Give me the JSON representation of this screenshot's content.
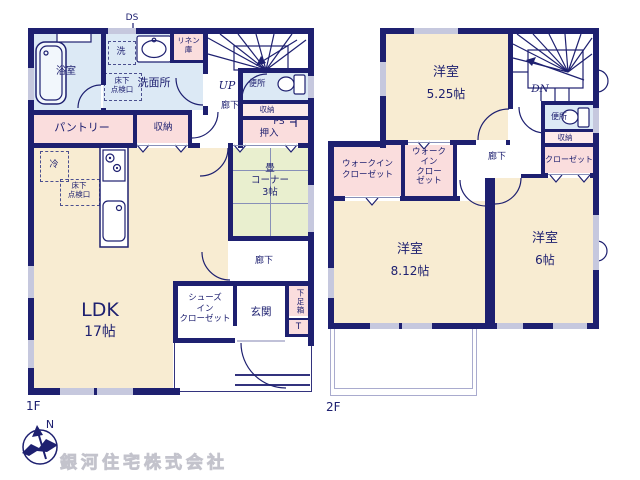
{
  "colors": {
    "wall": "#1e2070",
    "cream": "#f8ecd2",
    "blue": "#dce9f5",
    "pink": "#fadddd",
    "palepink": "#fdeaea",
    "green": "#e9efcf",
    "window": "#c6c8de"
  },
  "floor1": {
    "label": "1F",
    "ds": "DS",
    "bath": "浴室",
    "laundry": "洗",
    "washroom": "洗面所",
    "linen": "リネン\n庫",
    "underfloor_wash": "床下\n点検口",
    "up": "UP",
    "hall_upper": "廊下",
    "toilet": "便所",
    "toilet_storage": "収納",
    "ps": "PS",
    "oshiire": "押入",
    "pantry": "パントリー",
    "storage": "収納",
    "fridge": "冷",
    "underfloor_ldk": "床下\n点検口",
    "ldk": "LDK",
    "ldk_size": "17帖",
    "tatami": "畳\nコーナー\n3帖",
    "hall_lower": "廊下",
    "shoes_closet": "シューズ\nイン\nクローゼット",
    "entrance": "玄関",
    "shoe_box": "下足箱",
    "shoe_box_t": "T"
  },
  "floor2": {
    "label": "2F",
    "room_a": "洋室",
    "room_a_size": "5.25帖",
    "dn": "DN",
    "toilet": "便所",
    "toilet_storage": "収納",
    "closet": "クローゼット",
    "hall": "廊下",
    "wic_left": "ウォークイン\nクローゼット",
    "wic_right": "ウォーク\nイン\nクロー\nゼット",
    "room_b": "洋室",
    "room_b_size": "8.12帖",
    "room_c": "洋室",
    "room_c_size": "6帖"
  },
  "compass": {
    "north": "N"
  },
  "branding": {
    "company": "銀河住宅株式会社"
  }
}
